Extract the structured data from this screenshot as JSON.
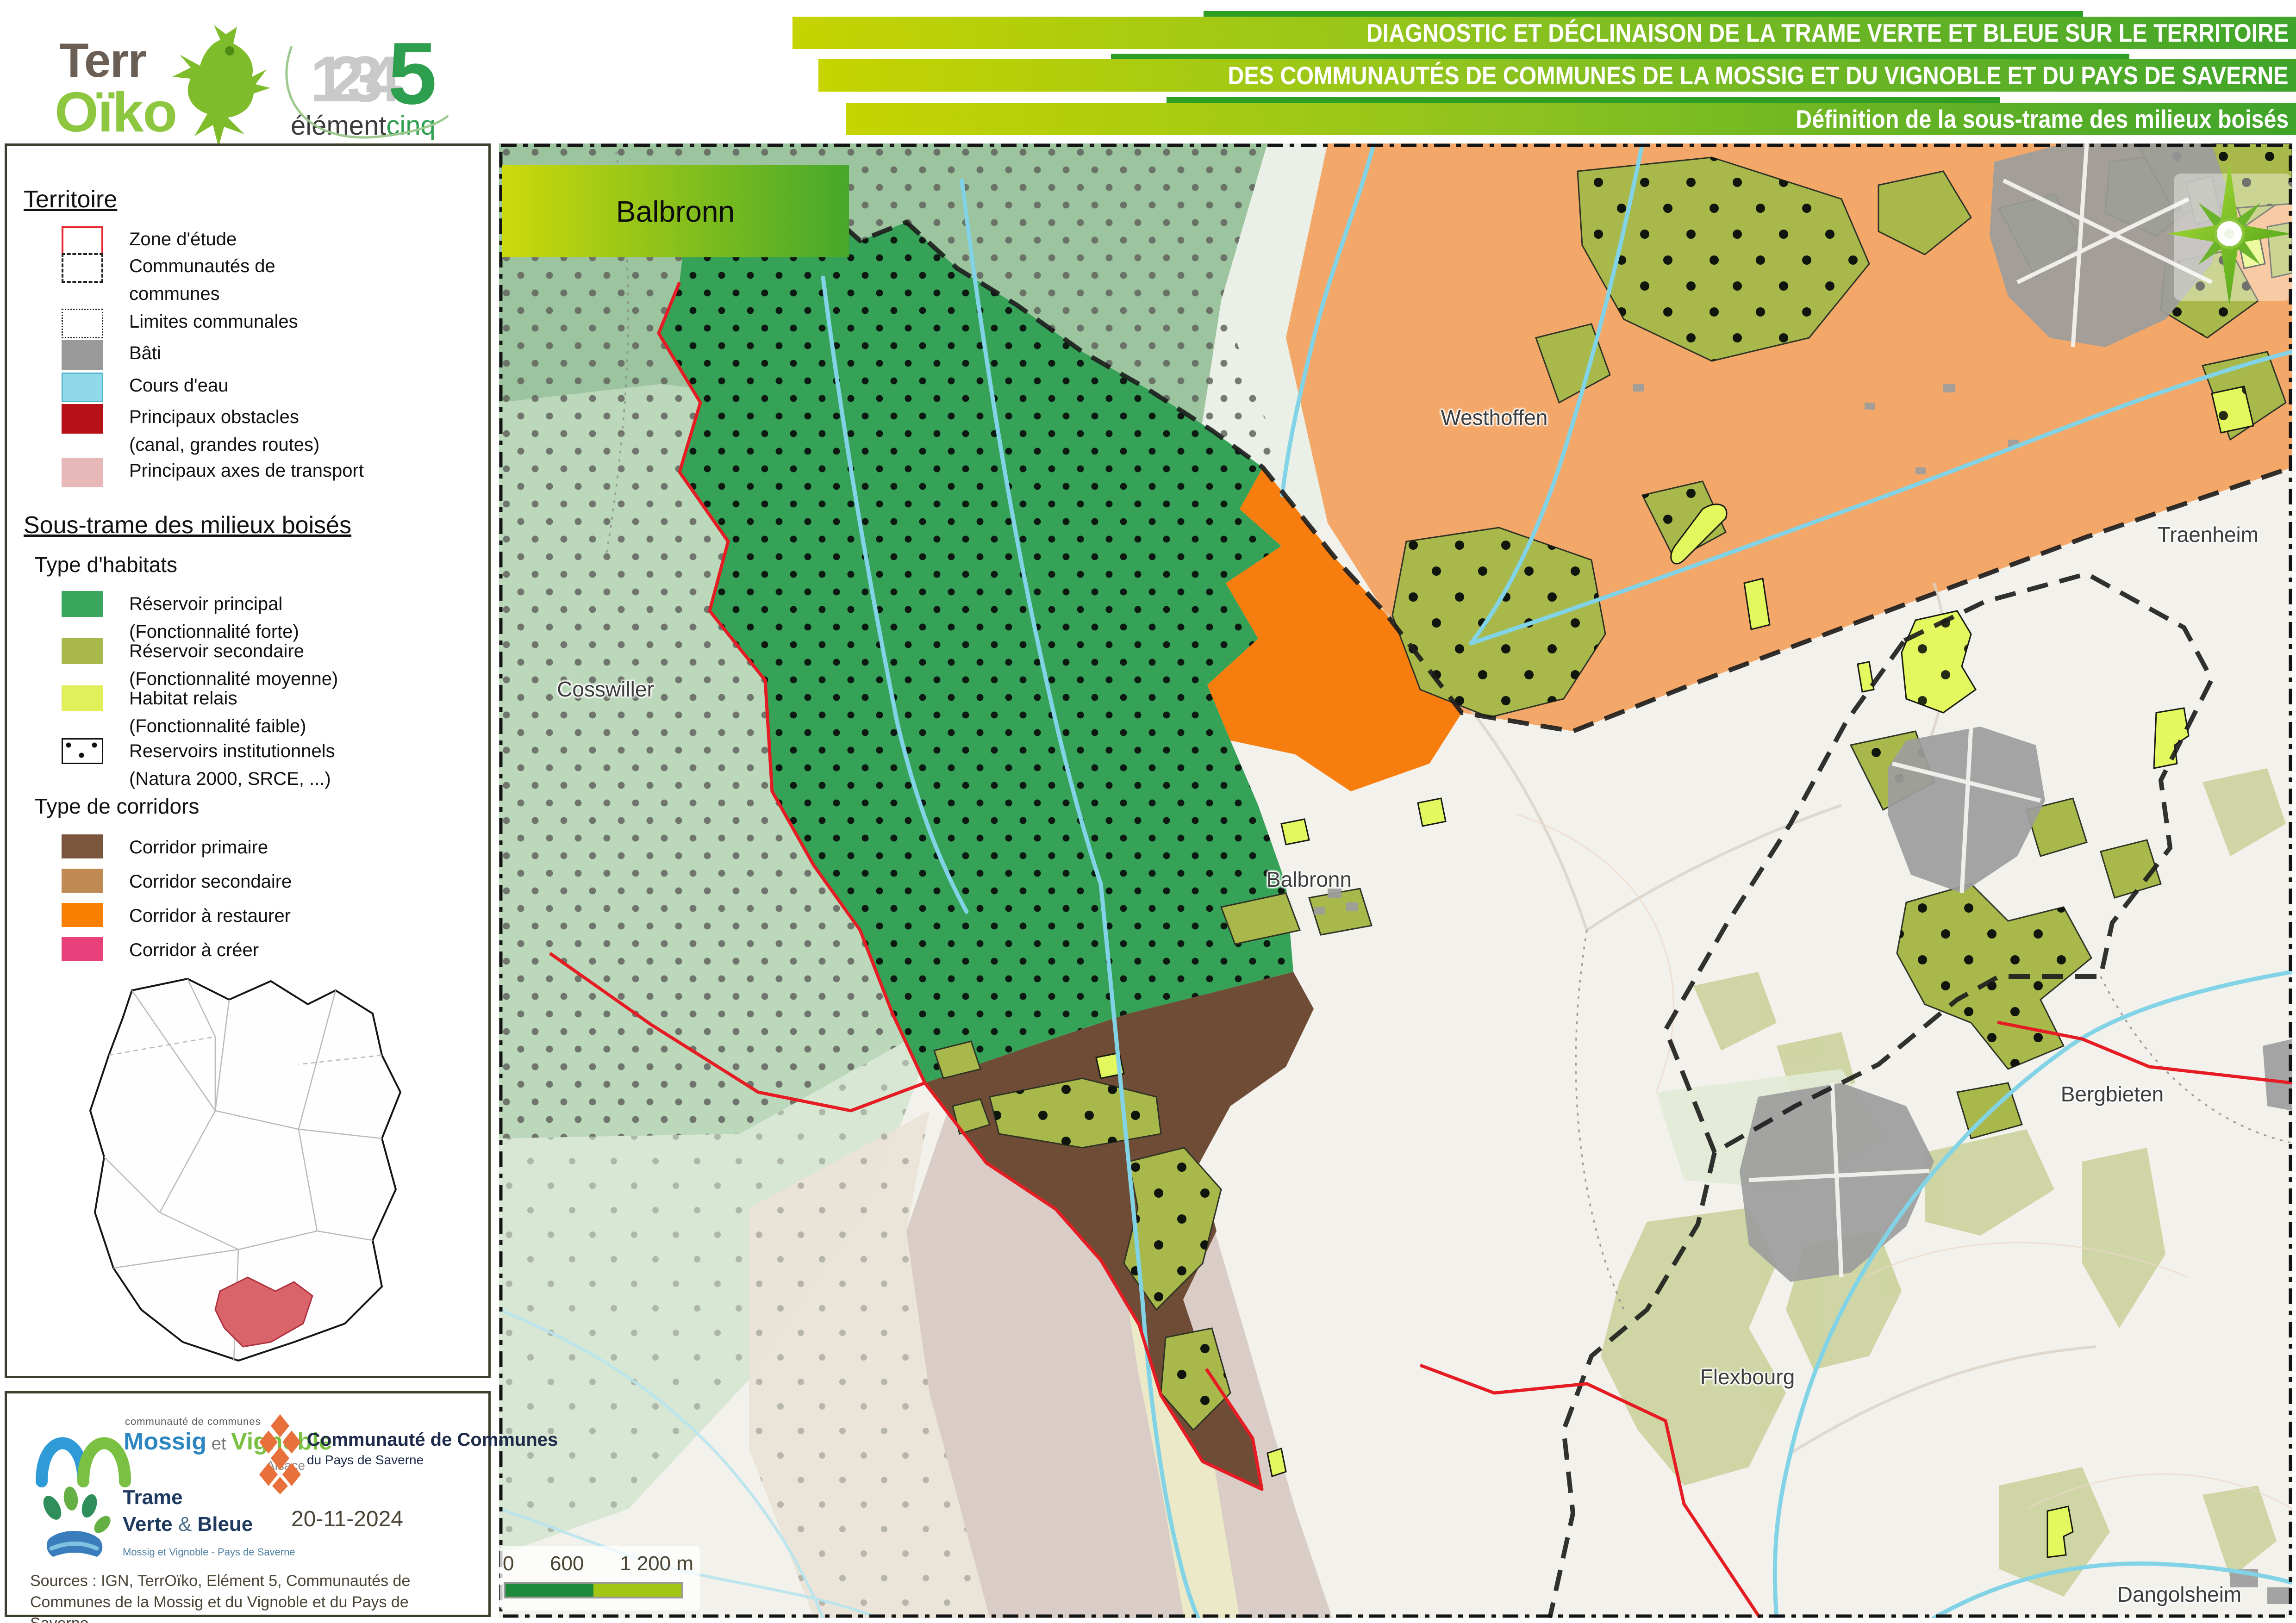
{
  "header": {
    "terroiko": {
      "line1": "Terr",
      "line2": "Oïko"
    },
    "element5": {
      "digits": "1234",
      "five": "5",
      "name_dark": "élément",
      "name_green": "cinq"
    },
    "banners": [
      "DIAGNOSTIC ET DÉCLINAISON DE LA TRAME VERTE ET BLEUE SUR LE TERRITOIRE",
      "DES COMMUNAUTÉS DE COMMUNES DE LA MOSSIG ET DU VIGNOBLE ET DU PAYS DE SAVERNE",
      "Définition de la sous-trame des milieux boisés"
    ]
  },
  "legend": {
    "territoire_title": "Territoire",
    "territoire": [
      {
        "label": "Zone d'étude"
      },
      {
        "label": "Communautés de",
        "sublabel": "communes"
      },
      {
        "label": "Limites communales"
      },
      {
        "label": "Bâti",
        "color": "#9a9a9a"
      },
      {
        "label": "Cours d'eau",
        "color": "#8fd9e8"
      },
      {
        "label": "Principaux obstacles",
        "sublabel": "(canal, grandes routes)",
        "color": "#b51117"
      },
      {
        "label": "Principaux axes de transport",
        "color": "#e7b8b8"
      }
    ],
    "soustrame_title": "Sous-trame des milieux boisés",
    "habitats_title": "Type d'habitats",
    "habitats": [
      {
        "label": "Réservoir principal",
        "sublabel": "(Fonctionnalité forte)",
        "color": "#3aa55c"
      },
      {
        "label": "Réservoir secondaire",
        "sublabel": "(Fonctionnalité moyenne)",
        "color": "#a9b84a"
      },
      {
        "label": "Habitat relais",
        "sublabel": "(Fonctionnalité faible)",
        "color": "#dff05a"
      },
      {
        "label": "Reservoirs institutionnels",
        "sublabel": "(Natura 2000, SRCE, ...)"
      }
    ],
    "corridors_title": "Type de corridors",
    "corridors": [
      {
        "label": "Corridor primaire",
        "color": "#7a563c"
      },
      {
        "label": "Corridor secondaire",
        "color": "#c08a55"
      },
      {
        "label": "Corridor à restaurer",
        "color": "#f97f00"
      },
      {
        "label": "Corridor à créer",
        "color": "#e8407a"
      }
    ]
  },
  "map": {
    "title_box": "Balbronn",
    "labels": [
      {
        "text": "Westhoffen"
      },
      {
        "text": "Traenheim"
      },
      {
        "text": "Cosswiller"
      },
      {
        "text": "Balbronn"
      },
      {
        "text": "Bergbieten"
      },
      {
        "text": "Flexbourg"
      },
      {
        "text": "Dangolsheim"
      }
    ],
    "scale": {
      "zero": "0",
      "mid": "600",
      "end": "1 200 m"
    }
  },
  "footer": {
    "mossig": {
      "small": "communauté de communes",
      "name1": "Mossig",
      "et": " et ",
      "name2": "Vignoble",
      "region": "Alsace"
    },
    "saverne": {
      "line1": "Communauté de Communes",
      "line2": "du Pays de Saverne"
    },
    "tvb": {
      "line1": "Trame",
      "line2": "Verte ",
      "amp": "& ",
      "line3": "Bleue",
      "sub": "Mossig et Vignoble - Pays de Saverne"
    },
    "date": "20-11-2024",
    "sources": "Sources : IGN, TerrOïko, Elément 5, Communautés de Communes de la Mossig et du Vignoble et du Pays de Saverne"
  },
  "colors": {
    "scale_dark": "#1e8a3c",
    "scale_light": "#a3c614",
    "reservoir_principal": "#35a257",
    "reservoir_secondaire": "#a9b84a",
    "habitat_relais": "#e3f75f",
    "corridor_primaire": "#6e4c36",
    "corridor_secondaire_map": "#f3a869",
    "corridor_restaurer": "#f67d0e",
    "cours_eau": "#82d3e6",
    "zone_etude": "#e51c23"
  }
}
